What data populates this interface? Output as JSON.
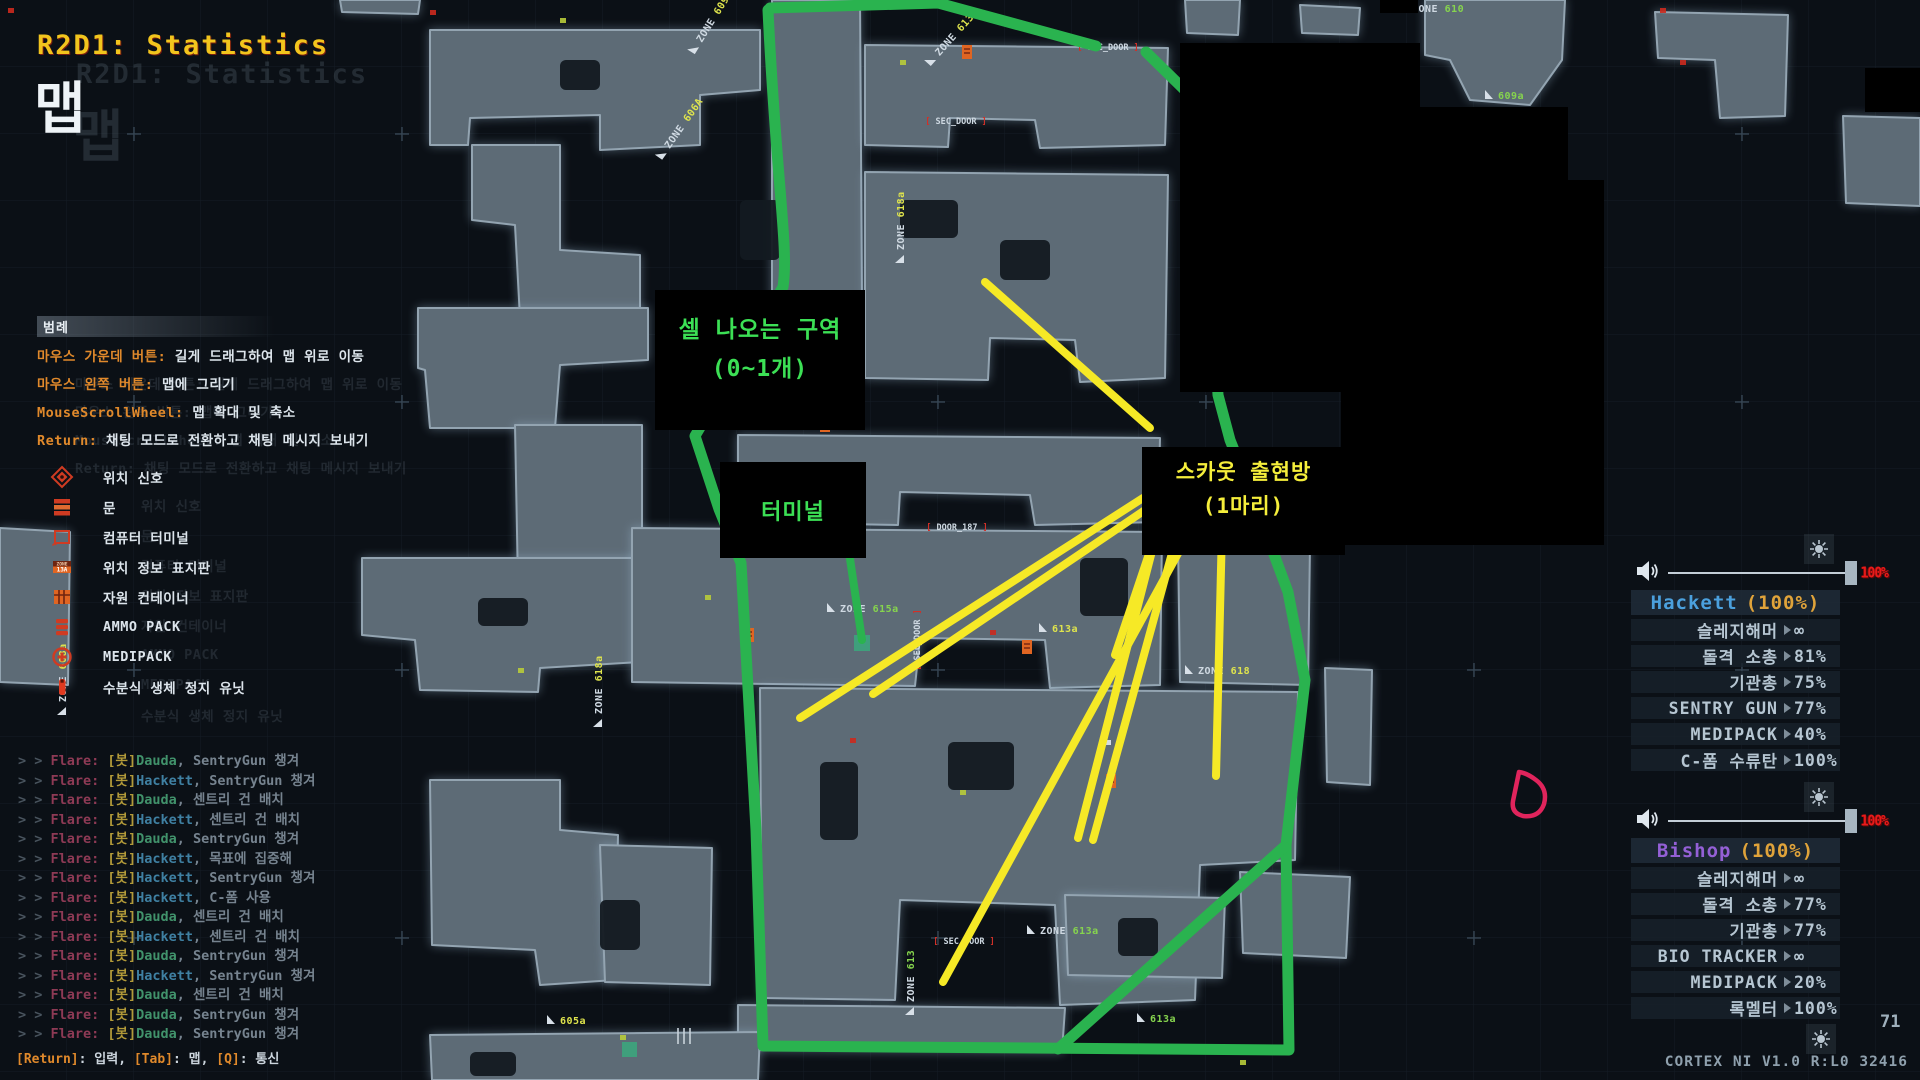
{
  "title": {
    "mission": "R2D1: Statistics",
    "page": "맵"
  },
  "colors": {
    "accent_green": "#2ab34f",
    "accent_yellow": "#f6e926",
    "annotation_green_text": "#3ce055",
    "annotation_yellow_text": "#f5ee3b",
    "title_yellow": "#f2c51d",
    "legend_key_orange": "#e0892b",
    "hackett_blue": "#4ba0dd",
    "bishop_purple": "#9460d6",
    "health_orange": "#e0a33a",
    "volume_red": "#e81a1a",
    "cursor_pink": "#e0245c",
    "map_blob": "#5d6b76"
  },
  "icons": {
    "speaker": "speaker-icon",
    "brightness": "brightness-icon",
    "value_arrow": "triangle-right-icon",
    "cursor": "draw-cursor-icon"
  },
  "legend": {
    "header": "범례",
    "controls": [
      {
        "key": "마우스 가운데 버튼:",
        "desc": "길게 드래그하여 맵 위로 이동"
      },
      {
        "key": "마우스 왼쪽 버튼:",
        "desc": "맵에 그리기"
      },
      {
        "key": "MouseScrollWheel:",
        "desc": "맵 확대 및 축소"
      },
      {
        "key": "Return:",
        "desc": "채팅 모드로 전환하고 채팅 메시지 보내기"
      }
    ],
    "items": [
      {
        "icon": "ping-icon",
        "label": "위치 신호"
      },
      {
        "icon": "door-icon",
        "label": "문"
      },
      {
        "icon": "terminal-icon",
        "label": "컴퓨터 터미널"
      },
      {
        "icon": "zone-sign-icon",
        "label": "위치 정보 표지판"
      },
      {
        "icon": "container-icon",
        "label": "자원 컨테이너"
      },
      {
        "icon": "ammo-icon",
        "label": "AMMO PACK"
      },
      {
        "icon": "medipack-icon",
        "label": "MEDIPACK"
      },
      {
        "icon": "hsu-icon",
        "label": "수분식 생체 정지 유닛"
      }
    ]
  },
  "annotations": {
    "cell_zone_line1": "셀 나오는 구역",
    "cell_zone_line2": "(0~1개)",
    "terminal": "터미널",
    "scout_line1": "스카웃 출현방",
    "scout_line2": "(1마리)"
  },
  "chat": {
    "speaker": "Flare:",
    "bot_tag": "[봇]",
    "lines": [
      {
        "name": "Dauda",
        "msg": "SentryGun 챙겨"
      },
      {
        "name": "Hackett",
        "msg": "SentryGun 챙겨"
      },
      {
        "name": "Dauda",
        "msg": "센트리 건 배치"
      },
      {
        "name": "Hackett",
        "msg": "센트리 건 배치"
      },
      {
        "name": "Dauda",
        "msg": "SentryGun 챙겨"
      },
      {
        "name": "Hackett",
        "msg": "목표에 집중해"
      },
      {
        "name": "Hackett",
        "msg": "SentryGun 챙겨"
      },
      {
        "name": "Hackett",
        "msg": "C-폼 사용"
      },
      {
        "name": "Dauda",
        "msg": "센트리 건 배치"
      },
      {
        "name": "Hackett",
        "msg": "센트리 건 배치"
      },
      {
        "name": "Dauda",
        "msg": "SentryGun 챙겨"
      },
      {
        "name": "Hackett",
        "msg": "SentryGun 챙겨"
      },
      {
        "name": "Dauda",
        "msg": "센트리 건 배치"
      },
      {
        "name": "Dauda",
        "msg": "SentryGun 챙겨"
      },
      {
        "name": "Dauda",
        "msg": "SentryGun 챙겨"
      }
    ],
    "footer": [
      {
        "key": "[Return]",
        "label": "입력"
      },
      {
        "key": "[Tab]",
        "label": "맵"
      },
      {
        "key": "[Q]",
        "label": "통신"
      }
    ]
  },
  "players": [
    {
      "name": "Hackett",
      "health": "(100%)",
      "name_color": "#4ba0dd",
      "volume": "100%",
      "items": [
        {
          "label": "슬레지해머",
          "value": "∞"
        },
        {
          "label": "돌격 소총",
          "value": "81%"
        },
        {
          "label": "기관총",
          "value": "75%"
        },
        {
          "label": "SENTRY GUN",
          "value": "77%"
        },
        {
          "label": "MEDIPACK",
          "value": "40%"
        },
        {
          "label": "C-폼 수류탄",
          "value": "100%"
        }
      ]
    },
    {
      "name": "Bishop",
      "health": "(100%)",
      "name_color": "#9460d6",
      "volume": "100%",
      "items": [
        {
          "label": "슬레지해머",
          "value": "∞"
        },
        {
          "label": "돌격 소총",
          "value": "77%"
        },
        {
          "label": "기관총",
          "value": "77%"
        },
        {
          "label": "BIO TRACKER",
          "value": "∞"
        },
        {
          "label": "MEDIPACK",
          "value": "20%"
        },
        {
          "label": "록멜터",
          "value": "100%"
        }
      ]
    }
  ],
  "status": {
    "page_number": "71",
    "system": "CORTEX NI V1.0 R:L0 32416"
  },
  "map": {
    "zone_labels": [
      {
        "t": "ZONE 609A",
        "x": 700,
        "y": 42,
        "r": -58,
        "c": "#dfe44d"
      },
      {
        "t": "ZONE 606A",
        "x": 668,
        "y": 148,
        "r": -55,
        "c": "#dfe44d"
      },
      {
        "t": "ZONE 613A",
        "x": 938,
        "y": 55,
        "r": -48,
        "c": "#dfe44d"
      },
      {
        "t": "ZONE 610",
        "x": 1412,
        "y": 10,
        "r": 0,
        "c": "#86d44e"
      },
      {
        "t": "609a",
        "x": 1498,
        "y": 97,
        "r": 0,
        "c": "#86d44e"
      },
      {
        "t": "ZONE 618a",
        "x": 902,
        "y": 250,
        "r": -90,
        "c": "#dfe44d"
      },
      {
        "t": "ZONE 618a",
        "x": 600,
        "y": 714,
        "r": -90,
        "c": "#dfe44d"
      },
      {
        "t": "ZONE 608a",
        "x": 64,
        "y": 702,
        "r": -90,
        "c": "#dfe44d"
      },
      {
        "t": "ZONE 615a",
        "x": 840,
        "y": 610,
        "r": 0,
        "c": "#86d44e"
      },
      {
        "t": "ZONE 613a",
        "x": 1040,
        "y": 932,
        "r": 0,
        "c": "#86d44e"
      },
      {
        "t": "ZONE 613",
        "x": 912,
        "y": 1002,
        "r": -90,
        "c": "#86d44e"
      },
      {
        "t": "ZONE 618",
        "x": 1198,
        "y": 672,
        "r": 0,
        "c": "#dfe44d"
      },
      {
        "t": "613a",
        "x": 1150,
        "y": 1020,
        "r": 0,
        "c": "#86d44e"
      },
      {
        "t": "605a",
        "x": 560,
        "y": 1022,
        "r": 0,
        "c": "#dfe44d"
      },
      {
        "t": "613a",
        "x": 1052,
        "y": 630,
        "r": 0,
        "c": "#dfe44d"
      }
    ],
    "sec_doors": [
      {
        "t": "SEC_DOOR",
        "x": 1108,
        "y": 50,
        "r": 0
      },
      {
        "t": "SEC_DOOR",
        "x": 956,
        "y": 124,
        "r": 0
      },
      {
        "t": "SEC_DOOR",
        "x": 964,
        "y": 944,
        "r": 0
      },
      {
        "t": "SEC_DOOR",
        "x": 920,
        "y": 640,
        "r": -90
      },
      {
        "t": "DOOR_187",
        "x": 957,
        "y": 530,
        "r": 0
      }
    ],
    "doors": [
      {
        "x": 962,
        "y": 45
      },
      {
        "x": 820,
        "y": 418
      },
      {
        "x": 1022,
        "y": 640
      },
      {
        "x": 1250,
        "y": 536
      },
      {
        "x": 1106,
        "y": 774
      },
      {
        "x": 744,
        "y": 628
      }
    ],
    "dots": [
      {
        "x": 8,
        "y": 8,
        "c": "#cc2a1e"
      },
      {
        "x": 430,
        "y": 10,
        "c": "#cc2a1e"
      },
      {
        "x": 1660,
        "y": 8,
        "c": "#cc2a1e"
      },
      {
        "x": 900,
        "y": 60,
        "c": "#b8cc3a"
      },
      {
        "x": 705,
        "y": 595,
        "c": "#b8cc3a"
      },
      {
        "x": 850,
        "y": 738,
        "c": "#cc2a1e"
      },
      {
        "x": 1105,
        "y": 740,
        "c": "#e0e8ee"
      },
      {
        "x": 960,
        "y": 790,
        "c": "#b8cc3a"
      },
      {
        "x": 518,
        "y": 668,
        "c": "#b8cc3a"
      },
      {
        "x": 560,
        "y": 18,
        "c": "#b8cc3a"
      },
      {
        "x": 1240,
        "y": 1060,
        "c": "#b8cc3a"
      },
      {
        "x": 620,
        "y": 1035,
        "c": "#b8cc3a"
      },
      {
        "x": 1332,
        "y": 540,
        "c": "#cc2a1e"
      },
      {
        "x": 1680,
        "y": 60,
        "c": "#cc2a1e"
      },
      {
        "x": 990,
        "y": 630,
        "c": "#cc2a1e"
      }
    ]
  }
}
